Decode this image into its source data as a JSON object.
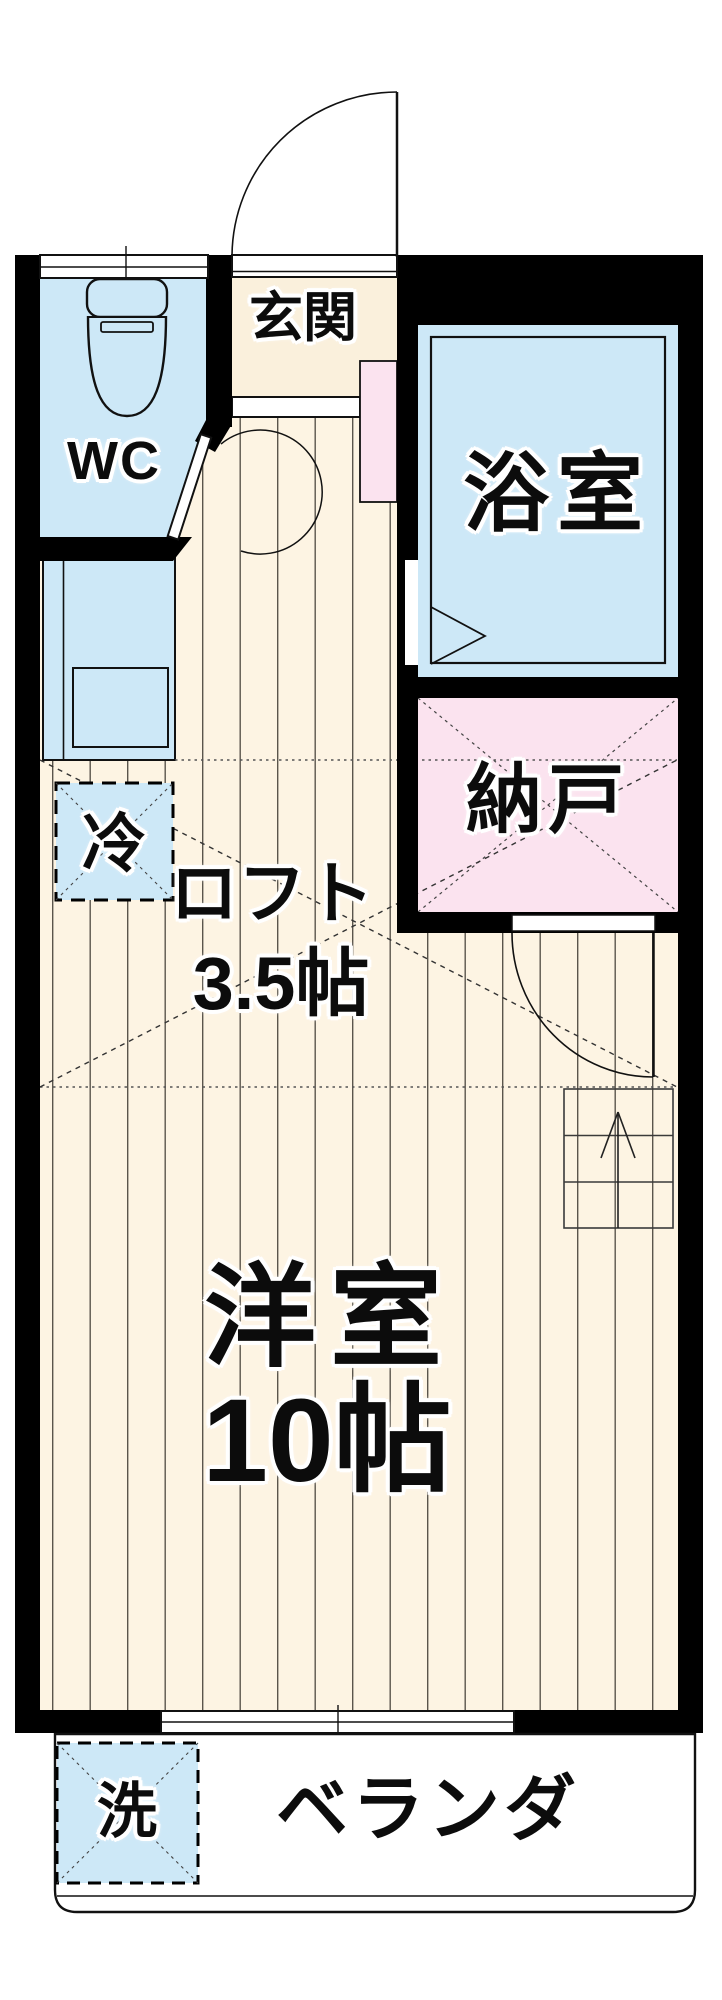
{
  "plan": {
    "title": "1K apartment floor plan",
    "rooms": {
      "entrance": {
        "label": "玄関"
      },
      "toilet": {
        "label": "WC"
      },
      "bathroom": {
        "label": "浴室"
      },
      "storage": {
        "label": "納戸"
      },
      "loft": {
        "label": "ロフト",
        "size": "3.5帖"
      },
      "main_room": {
        "label": "洋室",
        "size": "10帖"
      },
      "veranda": {
        "label": "ベランダ"
      }
    },
    "fixtures": {
      "refrigerator": {
        "label": "冷"
      },
      "washing_machine": {
        "label": "洗"
      }
    },
    "colors": {
      "wall": "#000000",
      "floor": "#fdf4e3",
      "floor_stripe": "#5a554c",
      "water_rooms_blue": "#cde8f7",
      "storage_pink": "#fbe3ef",
      "entrance_floor": "#faf0dc",
      "outline": "#111111"
    }
  }
}
